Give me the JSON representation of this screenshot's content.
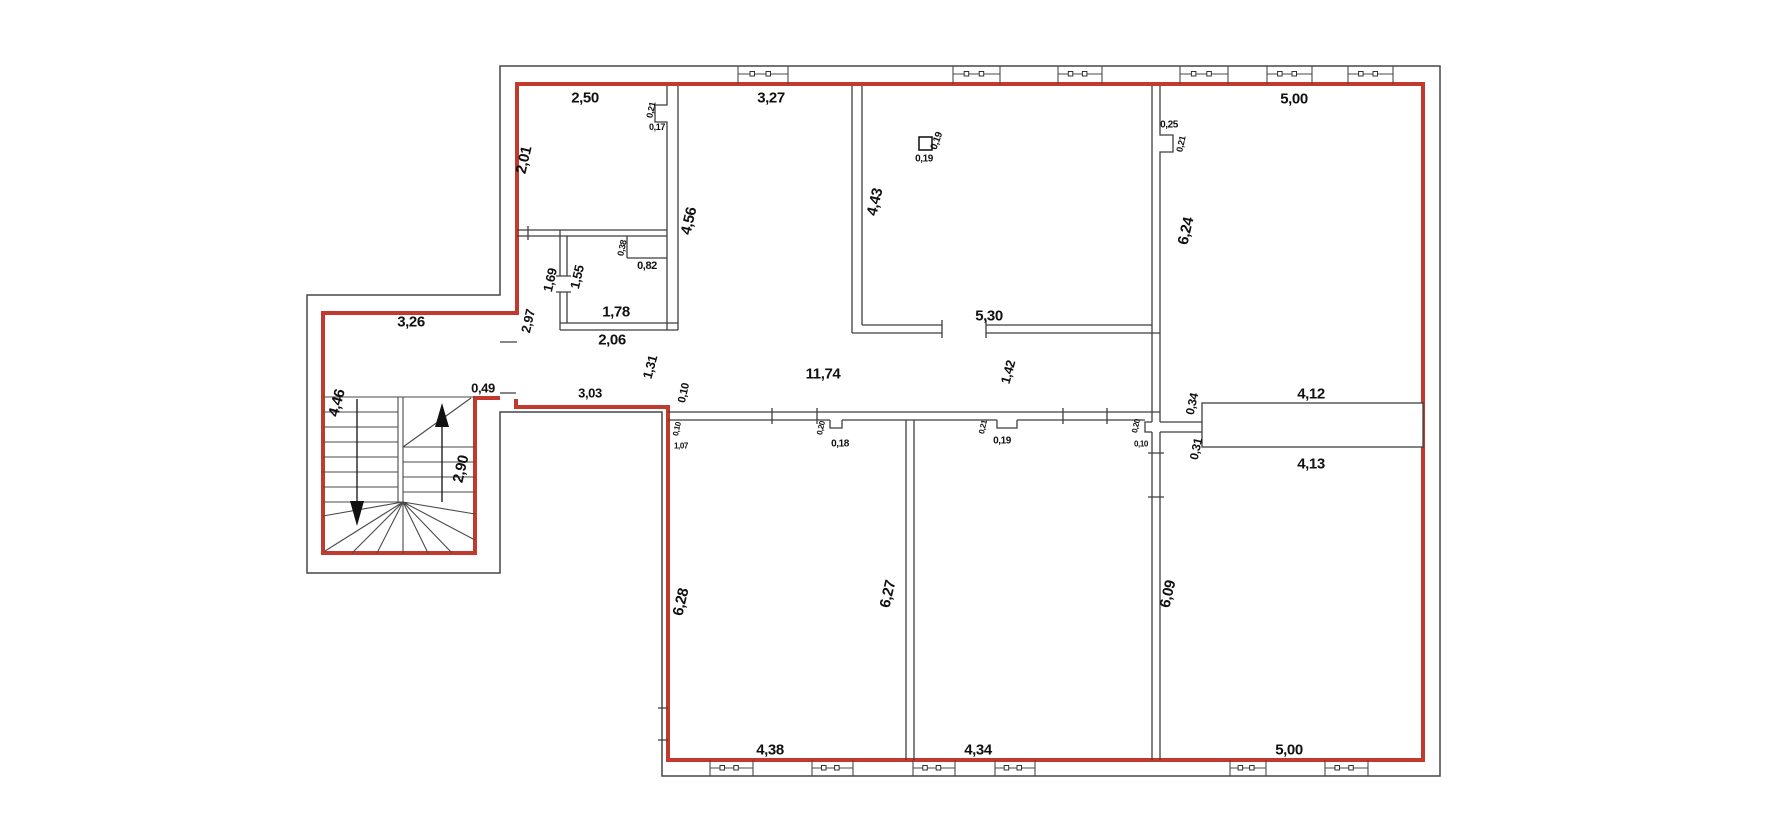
{
  "drawing": {
    "type": "floor-plan",
    "units": "meters"
  },
  "colors": {
    "apartment_outline": "#c23a2e",
    "walls": "#3f3f3f",
    "text": "#111111",
    "background": "#ffffff"
  },
  "dimension_labels": [
    {
      "text": "2,50",
      "x": 585,
      "y": 98,
      "rot": 0,
      "size": 15
    },
    {
      "text": "3,27",
      "x": 771,
      "y": 98,
      "rot": 0,
      "size": 15
    },
    {
      "text": "5,00",
      "x": 1294,
      "y": 99,
      "rot": 0,
      "size": 15
    },
    {
      "text": "2,01",
      "x": 524,
      "y": 160,
      "rot": -77,
      "size": 15
    },
    {
      "text": "0,21",
      "x": 651,
      "y": 110,
      "rot": -77,
      "size": 9
    },
    {
      "text": "0,17",
      "x": 657,
      "y": 127,
      "rot": 0,
      "size": 9
    },
    {
      "text": "4,56",
      "x": 689,
      "y": 221,
      "rot": -77,
      "size": 15
    },
    {
      "text": "4,43",
      "x": 875,
      "y": 202,
      "rot": -77,
      "size": 15
    },
    {
      "text": "0,19",
      "x": 924,
      "y": 159,
      "rot": 0,
      "size": 10
    },
    {
      "text": "0,19",
      "x": 937,
      "y": 141,
      "rot": -70,
      "size": 10
    },
    {
      "text": "0,25",
      "x": 1169,
      "y": 125,
      "rot": 0,
      "size": 10
    },
    {
      "text": "0,21",
      "x": 1181,
      "y": 144,
      "rot": -77,
      "size": 9
    },
    {
      "text": "6,24",
      "x": 1186,
      "y": 231,
      "rot": -77,
      "size": 15
    },
    {
      "text": "1,69",
      "x": 550,
      "y": 280,
      "rot": -77,
      "size": 13
    },
    {
      "text": "1,55",
      "x": 577,
      "y": 277,
      "rot": -77,
      "size": 13
    },
    {
      "text": "0,38",
      "x": 622,
      "y": 248,
      "rot": -77,
      "size": 9
    },
    {
      "text": "0,82",
      "x": 647,
      "y": 266,
      "rot": 0,
      "size": 11
    },
    {
      "text": "1,78",
      "x": 616,
      "y": 312,
      "rot": 0,
      "size": 15
    },
    {
      "text": "2,06",
      "x": 612,
      "y": 340,
      "rot": 0,
      "size": 15
    },
    {
      "text": "2,97",
      "x": 528,
      "y": 321,
      "rot": -77,
      "size": 13
    },
    {
      "text": "3,26",
      "x": 411,
      "y": 322,
      "rot": 0,
      "size": 15
    },
    {
      "text": "0,49",
      "x": 483,
      "y": 388,
      "rot": 0,
      "size": 13
    },
    {
      "text": "4,46",
      "x": 337,
      "y": 403,
      "rot": -75,
      "size": 15
    },
    {
      "text": "2,90",
      "x": 461,
      "y": 469,
      "rot": -77,
      "size": 15
    },
    {
      "text": "3,03",
      "x": 590,
      "y": 393,
      "rot": 0,
      "size": 13
    },
    {
      "text": "1,31",
      "x": 650,
      "y": 367,
      "rot": -75,
      "size": 13
    },
    {
      "text": "0,10",
      "x": 684,
      "y": 393,
      "rot": -77,
      "size": 11
    },
    {
      "text": "11,74",
      "x": 823,
      "y": 374,
      "rot": 0,
      "size": 15
    },
    {
      "text": "1,42",
      "x": 1008,
      "y": 372,
      "rot": -75,
      "size": 13
    },
    {
      "text": "5,30",
      "x": 989,
      "y": 316,
      "rot": 0,
      "size": 15
    },
    {
      "text": "0,10",
      "x": 677,
      "y": 429,
      "rot": -77,
      "size": 8
    },
    {
      "text": "1,07",
      "x": 681,
      "y": 446,
      "rot": 0,
      "size": 8
    },
    {
      "text": "0,20",
      "x": 821,
      "y": 428,
      "rot": -77,
      "size": 8
    },
    {
      "text": "0,18",
      "x": 840,
      "y": 444,
      "rot": 0,
      "size": 10
    },
    {
      "text": "0,21",
      "x": 983,
      "y": 427,
      "rot": -77,
      "size": 8
    },
    {
      "text": "0,19",
      "x": 1002,
      "y": 441,
      "rot": 0,
      "size": 10
    },
    {
      "text": "0,20",
      "x": 1136,
      "y": 426,
      "rot": -77,
      "size": 8
    },
    {
      "text": "0,10",
      "x": 1141,
      "y": 444,
      "rot": 0,
      "size": 8
    },
    {
      "text": "0,34",
      "x": 1192,
      "y": 404,
      "rot": -77,
      "size": 12
    },
    {
      "text": "0,31",
      "x": 1196,
      "y": 449,
      "rot": -77,
      "size": 12
    },
    {
      "text": "4,12",
      "x": 1311,
      "y": 394,
      "rot": 0,
      "size": 15
    },
    {
      "text": "4,13",
      "x": 1311,
      "y": 464,
      "rot": 0,
      "size": 15
    },
    {
      "text": "6,28",
      "x": 681,
      "y": 602,
      "rot": -77,
      "size": 15
    },
    {
      "text": "6,27",
      "x": 888,
      "y": 594,
      "rot": -77,
      "size": 15
    },
    {
      "text": "6,09",
      "x": 1168,
      "y": 594,
      "rot": -77,
      "size": 15
    },
    {
      "text": "4,38",
      "x": 770,
      "y": 750,
      "rot": 0,
      "size": 15
    },
    {
      "text": "4,34",
      "x": 978,
      "y": 750,
      "rot": 0,
      "size": 15
    },
    {
      "text": "5,00",
      "x": 1289,
      "y": 750,
      "rot": 0,
      "size": 15
    }
  ]
}
